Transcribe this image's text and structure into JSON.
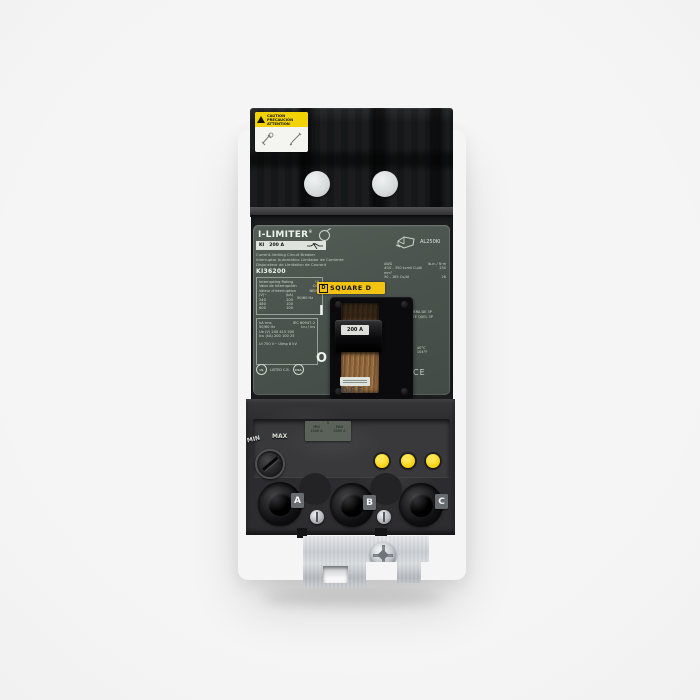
{
  "caution": {
    "l1": "CAUTION",
    "l2": "PRECAUCIÓN",
    "l3": "ATTENTION"
  },
  "nameplate": {
    "brand": "I-LIMITER",
    "reg": "®",
    "frame": "KI",
    "amps": "200 A",
    "desc_en": "Current-limiting Circuit Breaker",
    "desc_es": "Interruptor Automático Limitador de Corriente",
    "desc_fr": "Disjoncteur de Limitation de Courant",
    "catalog": "KI36200",
    "rating": {
      "h1": "Interrupting Rating",
      "a1": "UL",
      "h2": "Valor de Interrupción",
      "a2": "CSA",
      "h3": "Valeur d'interruption",
      "a3": "NEMA",
      "colv": "(V)~",
      "colk": "(kA)",
      "rows": [
        [
          "240",
          "200"
        ],
        [
          "480",
          "100"
        ],
        [
          "600",
          "100"
        ]
      ],
      "freq": "50/60 Hz"
    },
    "iec": {
      "r1l": "kA rms",
      "r1r": "IEC 60947-2",
      "r2l": "50/60 Hz",
      "r2r": "Icu / Ics",
      "r3": "Ue (V)  240  415  500",
      "r4": "Icu (kA)  200  100  25",
      "r5": "Ui 750 V~   Uimp 8 kV"
    },
    "cert": {
      "ul": "UL",
      "listed": "LISTED C.B.",
      "csa": "CSA"
    },
    "logo": {
      "d": "D",
      "text": "SQUARE D"
    },
    "on": "I",
    "off": "O",
    "lug": {
      "code": "AL250KI",
      "w1l": "AWG",
      "w1r": "lb-in / N·m",
      "w2l": "#10 - 350 kcmil  Cu/Al",
      "w2r": "250",
      "w3l": "mm²",
      "w4l": "50 - 185 Cu/Al",
      "w4r": "28",
      "t1": "40°C ~ 3Ø 3P",
      "t2": "40°C ~ CUALQUIERA DE 3P",
      "t3": "40°C ~ N'IMPORTE QUEL 3P",
      "m1": "E1",
      "m2": "Cat A",
      "m3": "40°C",
      "m4": "104°F",
      "ce": "CE"
    }
  },
  "handle": {
    "rating": "200 A",
    "molded": "OFF"
  },
  "trip": {
    "num": "5",
    "minl": "MIN",
    "minv": "1000 A",
    "maxl": "MAX",
    "maxv": "2000 A",
    "dial_min": "MIN",
    "dial_max": "MAX"
  },
  "terminals": {
    "a": "A",
    "b": "B",
    "c": "C"
  },
  "colors": {
    "brand_yellow": "#f2c411",
    "caution_yellow": "#f2d203",
    "indicator_yellow": "#f7cf08",
    "label_green": "#4a534d"
  }
}
